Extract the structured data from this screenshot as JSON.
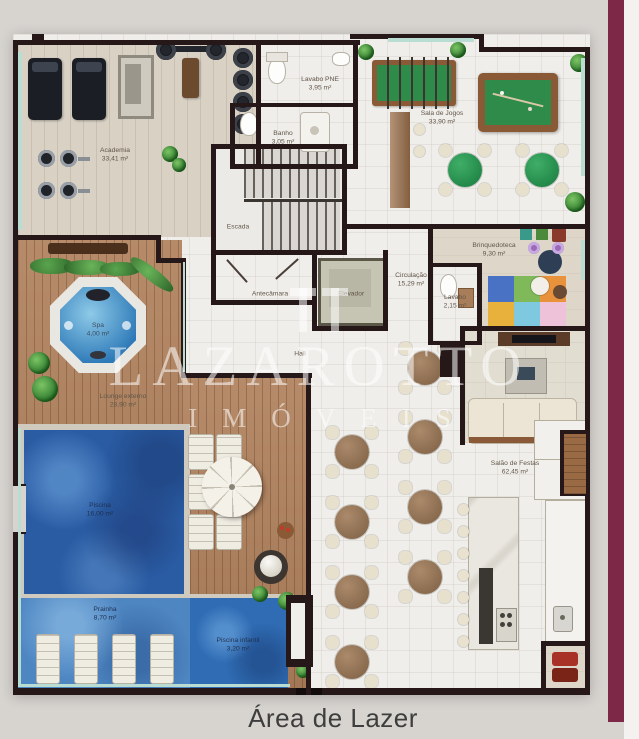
{
  "meta": {
    "title": "Área de Lazer"
  },
  "watermark": {
    "brand": "LAZAROTTO",
    "tagline": "IMÓVEIS"
  },
  "rooms": {
    "academia": {
      "name": "Academia",
      "area": "33,41 m²"
    },
    "lavabo_pne": {
      "name": "Lavabo PNE",
      "area": "3,95 m²"
    },
    "banho": {
      "name": "Banho",
      "area": "3,05 m²"
    },
    "sala_de_jogos": {
      "name": "Sala de Jogos",
      "area": "33,90 m²"
    },
    "escada": {
      "name": "Escada",
      "area": ""
    },
    "antecamara": {
      "name": "Antecâmara",
      "area": ""
    },
    "elevador": {
      "name": "Elevador",
      "area": ""
    },
    "circulacao": {
      "name": "Circulação",
      "area": "15,29 m²"
    },
    "brinquedoteca": {
      "name": "Brinquedoteca",
      "area": "9,30 m²"
    },
    "lavabo": {
      "name": "Lavabo",
      "area": "2,15 m²"
    },
    "hall": {
      "name": "Hall",
      "area": ""
    },
    "spa": {
      "name": "Spa",
      "area": "4,00 m²"
    },
    "lounge_externo": {
      "name": "Lounge externo",
      "area": "28,90 m²"
    },
    "piscina": {
      "name": "Piscina",
      "area": "16,00 m²"
    },
    "prainha": {
      "name": "Prainha",
      "area": "8,70 m²"
    },
    "piscina_infantil": {
      "name": "Piscina infantil",
      "area": "3,20 m²"
    },
    "salao_de_festas": {
      "name": "Salão de Festas",
      "area": "62,45 m²"
    }
  }
}
